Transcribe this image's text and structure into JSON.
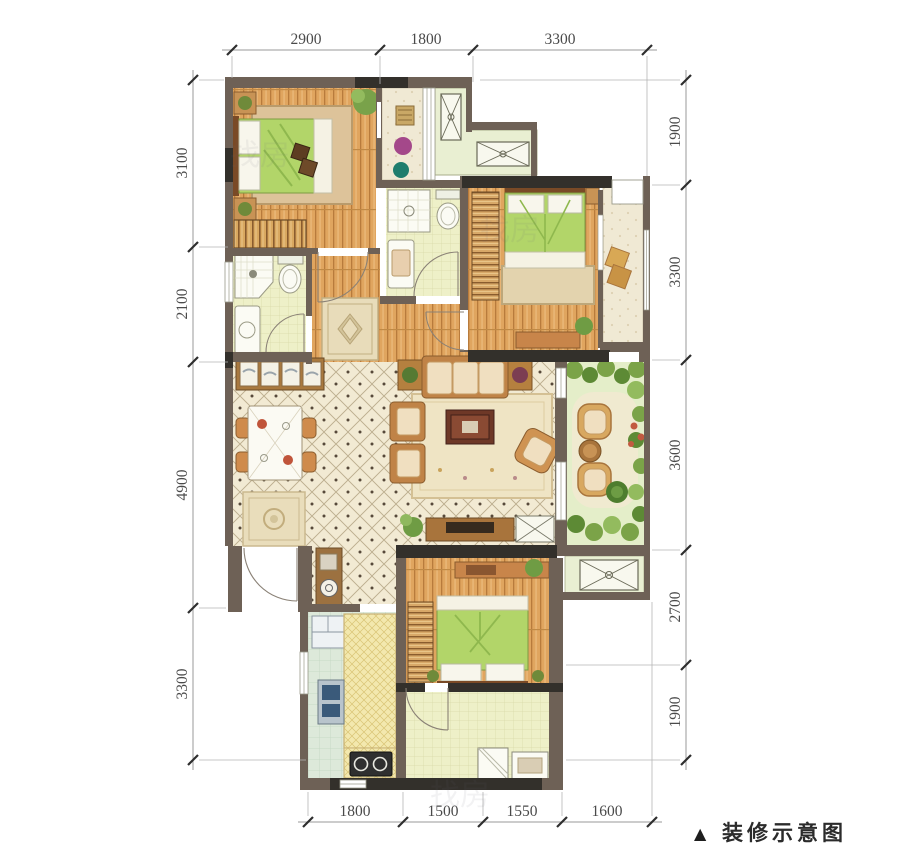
{
  "caption": {
    "marker": "▲",
    "text": "装修示意图"
  },
  "dimensions": {
    "top": [
      {
        "value": "2900"
      },
      {
        "value": "1800"
      },
      {
        "value": "3300"
      }
    ],
    "bottom": [
      {
        "value": "1800"
      },
      {
        "value": "1500"
      },
      {
        "value": "1550"
      },
      {
        "value": "1600"
      }
    ],
    "left": [
      {
        "value": "3100"
      },
      {
        "value": "2100"
      },
      {
        "value": "4900"
      },
      {
        "value": "3300"
      }
    ],
    "right": [
      {
        "value": "1900"
      },
      {
        "value": "3300"
      },
      {
        "value": "3600"
      },
      {
        "value": "2700"
      },
      {
        "value": "1900"
      }
    ]
  },
  "watermark": {
    "text": "找房"
  },
  "colors": {
    "wall_brown": "#6e6156",
    "wall_dark": "#33302b",
    "wood_floor": "#e0a55f",
    "tile_floor": "#f2ead3",
    "bath_floor": "#eef0c8",
    "kitchen_floor": "#dde9da",
    "platform_green": "#e9efd2",
    "garden_green": "#dcebc0",
    "bed_green": "#b2d569",
    "furniture_tan": "#d1924f"
  }
}
